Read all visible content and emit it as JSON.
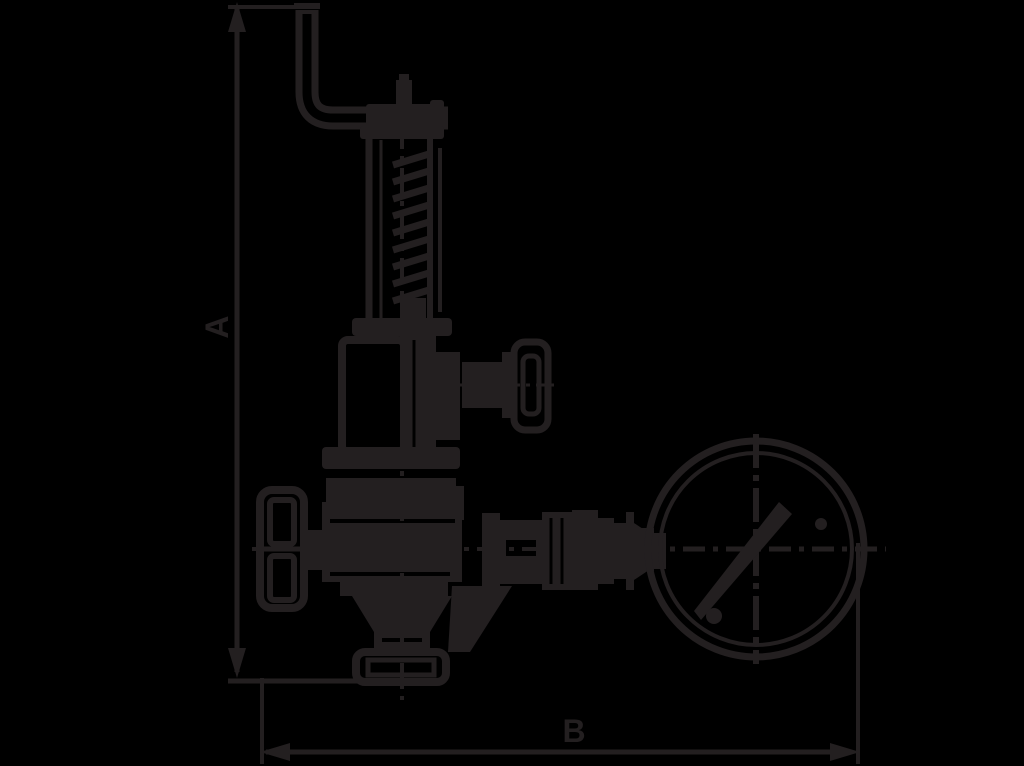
{
  "diagram": {
    "kind": "technical-outline-drawing",
    "subject": "safety-relief-valve-with-pressure-gauge",
    "colors": {
      "background": "#000000",
      "line": "#231f20"
    },
    "dimensions": {
      "a": {
        "label": "A",
        "orientation": "vertical"
      },
      "b": {
        "label": "B",
        "orientation": "horizontal"
      }
    },
    "parts": [
      "lifting-lever",
      "spindle-cap",
      "spring-housing",
      "spring-coils",
      "bonnet-flange",
      "bonnet",
      "test-valve-knob",
      "handwheel",
      "valve-body",
      "outlet-cone",
      "inlet-flange",
      "gauge-fittings",
      "gauge-stem",
      "pressure-gauge",
      "gauge-needle"
    ]
  }
}
